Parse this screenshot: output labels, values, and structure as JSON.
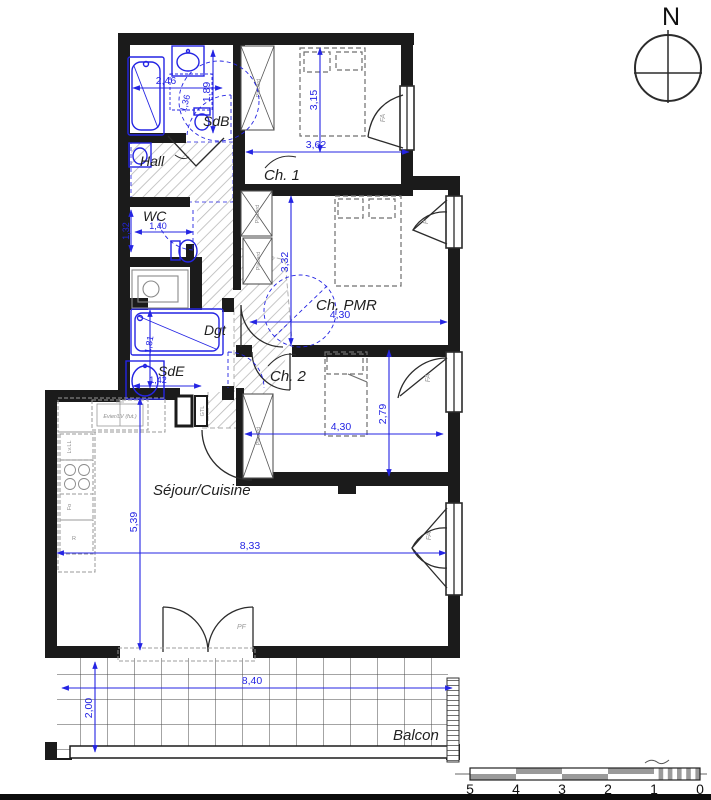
{
  "compass": {
    "north_label": "N"
  },
  "rooms": {
    "sdb": "SdB",
    "hall": "Hall",
    "wc": "WC",
    "dgt": "Dgt",
    "sde": "SdE",
    "ch1": "Ch. 1",
    "chpmr": "Ch. PMR",
    "ch2": "Ch. 2",
    "sejour": "Séjour/Cuisine",
    "balcon": "Balcon"
  },
  "dimensions": {
    "sdb_width": "2,46",
    "sdb_height": "1,89",
    "sdb_fixture": "1,36",
    "ch1_width": "3,62",
    "ch1_height": "3,15",
    "wc_height": "1,32",
    "wc_width": "1,40",
    "chpmr_height": "3,32",
    "chpmr_width": "4,30",
    "sde_height": "1,81",
    "sde_width": "1,42",
    "ch2_width": "4,30",
    "ch2_height": "2,79",
    "sejour_height": "5,39",
    "sejour_width": "8,33",
    "balcon_width": "8,40",
    "balcon_depth": "2,00"
  },
  "fixtures": {
    "placard": "Placard",
    "gtl": "GTL",
    "kitchen_sink": "Evier/LV (fut.)",
    "washer": "Lv.LL",
    "oven": "Fo",
    "fridge": "R"
  },
  "openings": {
    "pf": "PF",
    "fa": "FA",
    "f": "F"
  },
  "scale_bar": {
    "labels": [
      "5",
      "4",
      "3",
      "2",
      "1",
      "0"
    ]
  },
  "colors": {
    "dimension_blue": "#2424e3",
    "wall_black": "#1b1b1b"
  }
}
